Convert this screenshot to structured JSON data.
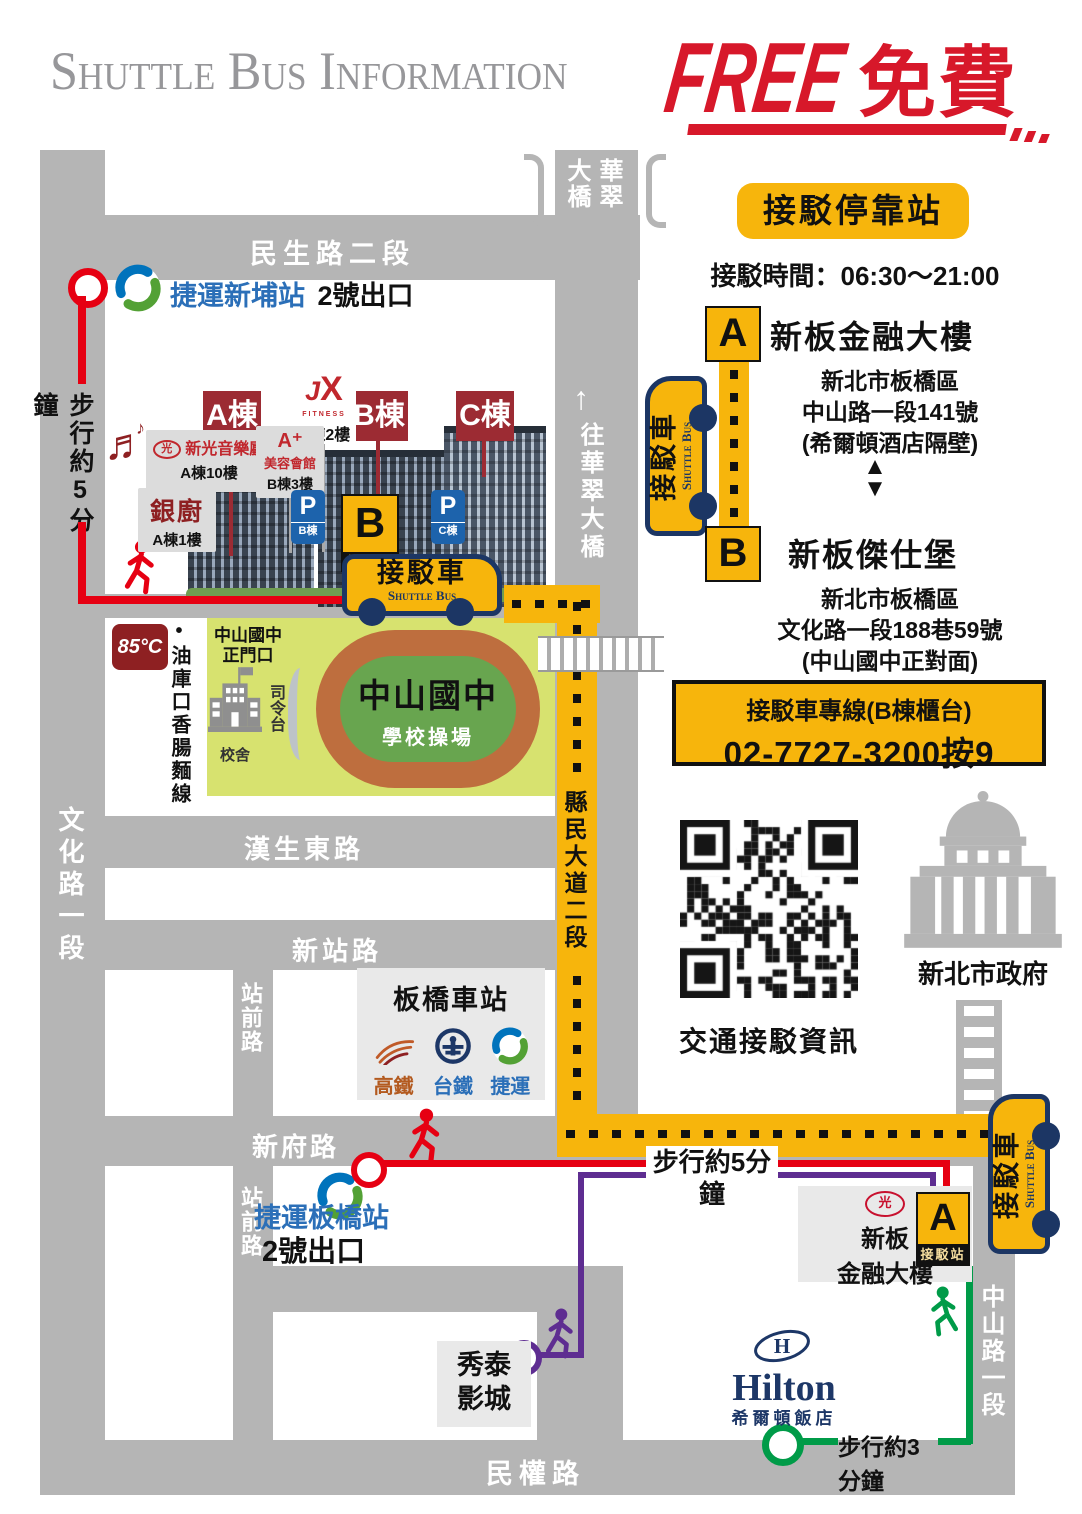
{
  "header": {
    "title": "Shuttle Bus Information",
    "free_en": "FREE",
    "free_zh": "免費"
  },
  "panel": {
    "badge": "接駁停靠站",
    "hours": "接駁時間：06:30～21:00",
    "stop_a": {
      "letter": "A",
      "name": "新板金融大樓",
      "addr1": "新北市板橋區",
      "addr2": "中山路一段141號",
      "addr3": "(希爾頓酒店隔壁)"
    },
    "stop_b": {
      "letter": "B",
      "name": "新板傑仕堡",
      "addr1": "新北市板橋區",
      "addr2": "文化路一段188巷59號",
      "addr3": "(中山國中正對面)"
    },
    "hotline_title": "接駁車專線(B棟櫃台)",
    "hotline_number": "02-7727-3200按9",
    "qr_caption": "交通接駁資訊",
    "gov": "新北市政府"
  },
  "bus": {
    "zh": "接駁車",
    "en": "Shuttle Bus"
  },
  "roads": {
    "minsheng": "民生路二段",
    "hansheng": "漢生東路",
    "xinzhan": "新站路",
    "xinfu": "新府路",
    "minquan": "民權路",
    "wenhua": "文化路一段",
    "zhanqian": "站前路",
    "xianmin": "縣民大道二段",
    "zhongshan": "中山路一段",
    "bridge_right": "華翠",
    "bridge_left": "大橋",
    "to_bridge_arrow": "↑",
    "to_bridge": "往華翠大橋"
  },
  "mrt": {
    "xinpu_name": "捷運新埔站",
    "xinpu_exit": "2號出口",
    "banqiao_name": "捷運板橋站",
    "banqiao_exit": "2號出口"
  },
  "walks": {
    "w5_left": "步行約5分鐘",
    "w5_mid": "步行約5分鐘",
    "w3": "步行約3分鐘"
  },
  "buildings": {
    "a": "A棟",
    "b": "B棟",
    "c": "C棟",
    "jx_j": "J",
    "jx_x": "X",
    "jx_sub": "FITNESS",
    "jx_floor": "B棟2樓",
    "concert_logo": "光",
    "concert_name": "新光音樂廳",
    "concert_floor": "A棟10樓",
    "beauty_mark": "A⁺",
    "beauty_name": "美容會館",
    "beauty_floor": "B棟3樓",
    "silver_name": "銀廚",
    "silver_floor": "A棟1樓",
    "parking": "P",
    "parking_b": "B棟",
    "parking_c": "C棟"
  },
  "stops": {
    "a": "A",
    "b": "B",
    "label": "接駁站"
  },
  "school": {
    "gate1": "中山國中",
    "gate2": "正門口",
    "hall": "校舍",
    "stage": "司令台",
    "name": "中山國中",
    "field": "學校操場"
  },
  "poi": {
    "c85": "85°C",
    "sausage": "•油庫口香腸麵線",
    "station": "板橋車站",
    "hsr": "高鐵",
    "tra": "台鐵",
    "metro": "捷運",
    "xiutai1": "秀泰",
    "xiutai2": "影城",
    "hilton_en": "Hilton",
    "hilton_zh": "希爾頓飯店",
    "fin_logo": "光",
    "fin_name1": "新板",
    "fin_name2": "金融大樓"
  },
  "colors": {
    "yellow": "#F7B50C",
    "navy": "#1C3664",
    "route_red": "#E60012",
    "route_purple": "#5E2D91",
    "route_green": "#009B48",
    "sign_red": "#9C2B33",
    "blue_text": "#2B6FB8",
    "free_red": "#D7182A"
  }
}
